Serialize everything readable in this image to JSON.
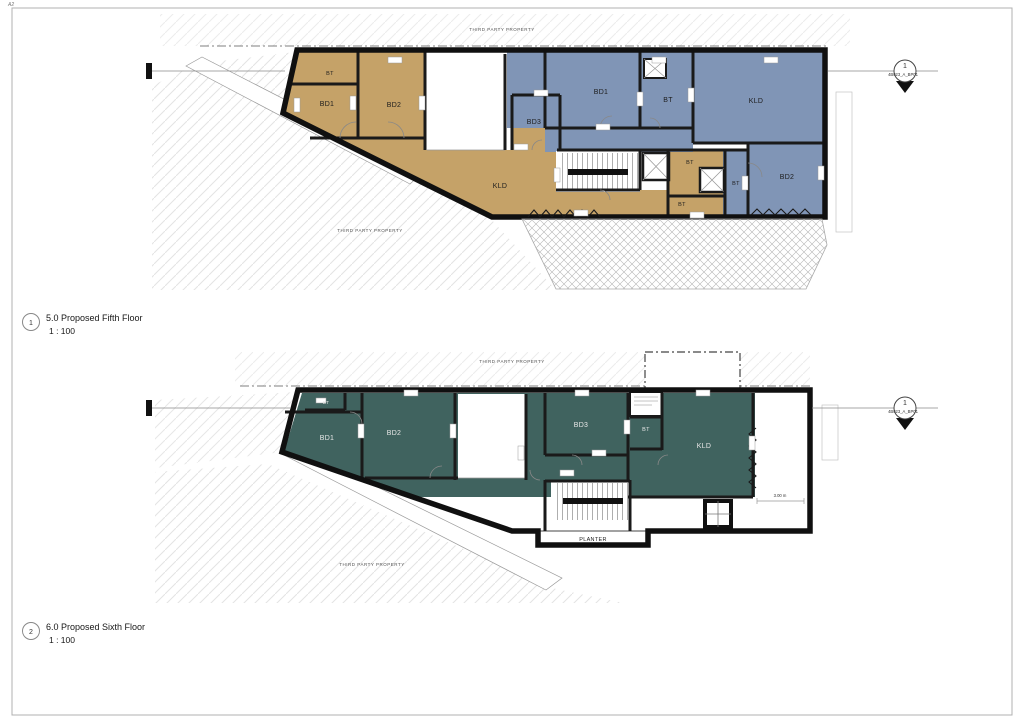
{
  "sheet": {
    "size_label": "A2"
  },
  "colors": {
    "tan": "#c5a268",
    "blue": "#8095b6",
    "teal": "#40635f",
    "wall": "#161616"
  },
  "plans": [
    {
      "callout": "1",
      "title": "5.0 Proposed Fifth Floor",
      "scale": "1 : 100",
      "third_party_top": "THIRD PARTY PROPERTY",
      "third_party_side": "THIRD PARTY PROPERTY",
      "marker": {
        "number": "1",
        "ref": "4B023_A_BP01"
      },
      "rooms": [
        {
          "label": "BT"
        },
        {
          "label": "BD1"
        },
        {
          "label": "BD2"
        },
        {
          "label": "BD3"
        },
        {
          "label": "KLD"
        },
        {
          "label": "BD1"
        },
        {
          "label": "BT"
        },
        {
          "label": "KLD"
        },
        {
          "label": "BD2"
        },
        {
          "label": "BT"
        },
        {
          "label": "BT"
        },
        {
          "label": "BT"
        }
      ]
    },
    {
      "callout": "2",
      "title": "6.0 Proposed Sixth Floor",
      "scale": "1 : 100",
      "third_party_top": "THIRD PARTY PROPERTY",
      "third_party_side": "THIRD PARTY PROPERTY",
      "marker": {
        "number": "1",
        "ref": "4B023_A_BP01"
      },
      "planter": "PLANTER",
      "dim_right": "3.00 m",
      "rooms": [
        {
          "label": "BT"
        },
        {
          "label": "BD1"
        },
        {
          "label": "BD2"
        },
        {
          "label": "BD3"
        },
        {
          "label": "BT"
        },
        {
          "label": "KLD"
        }
      ]
    }
  ]
}
